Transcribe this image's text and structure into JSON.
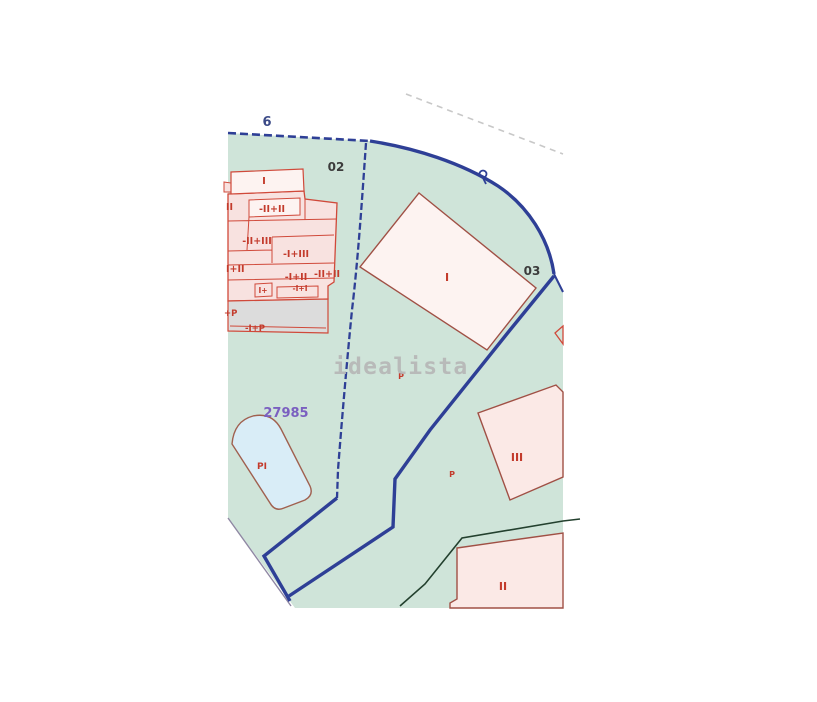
{
  "watermark": {
    "text": "idealista"
  },
  "labels": {
    "parcel_number": "6",
    "subparcel_02": "02",
    "subparcel_03": "03",
    "plot_code": "27985",
    "pool": "PI",
    "parking_center": "P",
    "parking_right": "P",
    "building_main": "I",
    "building_iii": "III",
    "building_ii": "II",
    "cluster": {
      "top_i": "I",
      "left_ii": "II",
      "mid_ii_ii": "-II+II",
      "mid_ii_iii": "-II+III",
      "mid_i_iii": "-I+III",
      "left_i_ii": "I+II",
      "mid_i_ii": "-I+II",
      "right_ii_ii": "-II+II",
      "small_i_plus": "I+",
      "small_i_i": "-I+I",
      "plus_p": "+P",
      "mid_i_p": "-I+P"
    }
  },
  "colors": {
    "parcel_fill_green": "#cfe4d9",
    "boundary_blue": "#2e3f96",
    "building_fill_pink": "#f8e2e0",
    "building_fill_pale": "#fdf3f1",
    "building_fill_light": "#fbe9e6",
    "building_outline_red": "#d0493a",
    "building_outline_maroon": "#a05045",
    "patio_fill_gray": "#dcdcdc",
    "pool_fill": "#d9edf7",
    "path_dark_green": "#23402e",
    "road_dash_gray": "#c8c8c8",
    "edge_gray_purple": "#8f87a3",
    "plot_code_purple": "#7a5fc0",
    "label_red": "#c33b2c",
    "label_dark": "#3c3c3c",
    "label_navy": "#3b4a87",
    "watermark_gray": "#b6b6b6"
  }
}
